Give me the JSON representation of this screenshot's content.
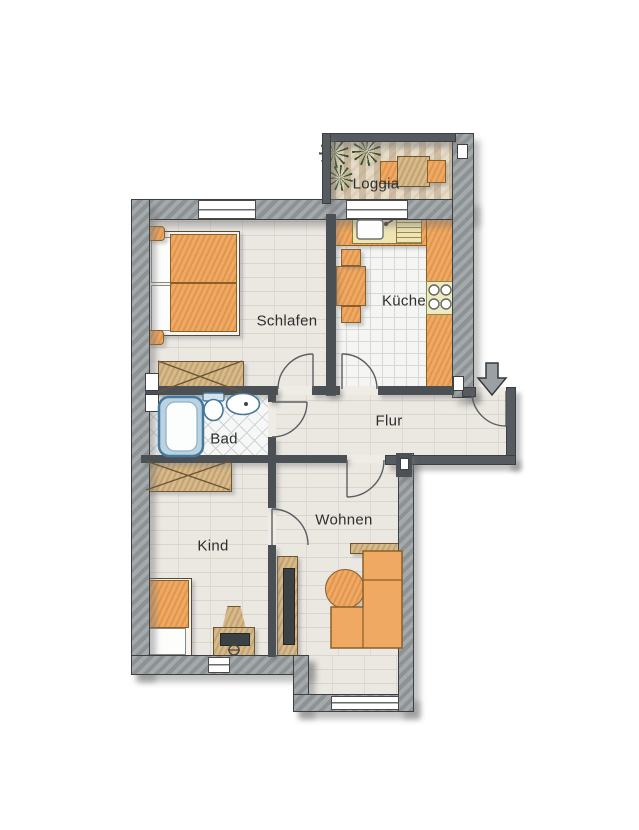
{
  "plan": {
    "rooms": [
      {
        "id": "loggia",
        "label": "Loggia"
      },
      {
        "id": "schlafen",
        "label": "Schlafen"
      },
      {
        "id": "kueche",
        "label": "Küche"
      },
      {
        "id": "bad",
        "label": "Bad"
      },
      {
        "id": "flur",
        "label": "Flur"
      },
      {
        "id": "kind",
        "label": "Kind"
      },
      {
        "id": "wohnen",
        "label": "Wohnen"
      }
    ],
    "entrance": {
      "icon": "down-arrow-icon"
    },
    "colors": {
      "outer_wall": "#979da1",
      "inner_wall": "#4b5054",
      "floor_beige": "#ebe8e2",
      "furniture_orange": "#f0a963",
      "furniture_wood": "#d8ba8a",
      "bath_blue": "#b9d3e3",
      "plant_green": "#3a5526"
    }
  }
}
